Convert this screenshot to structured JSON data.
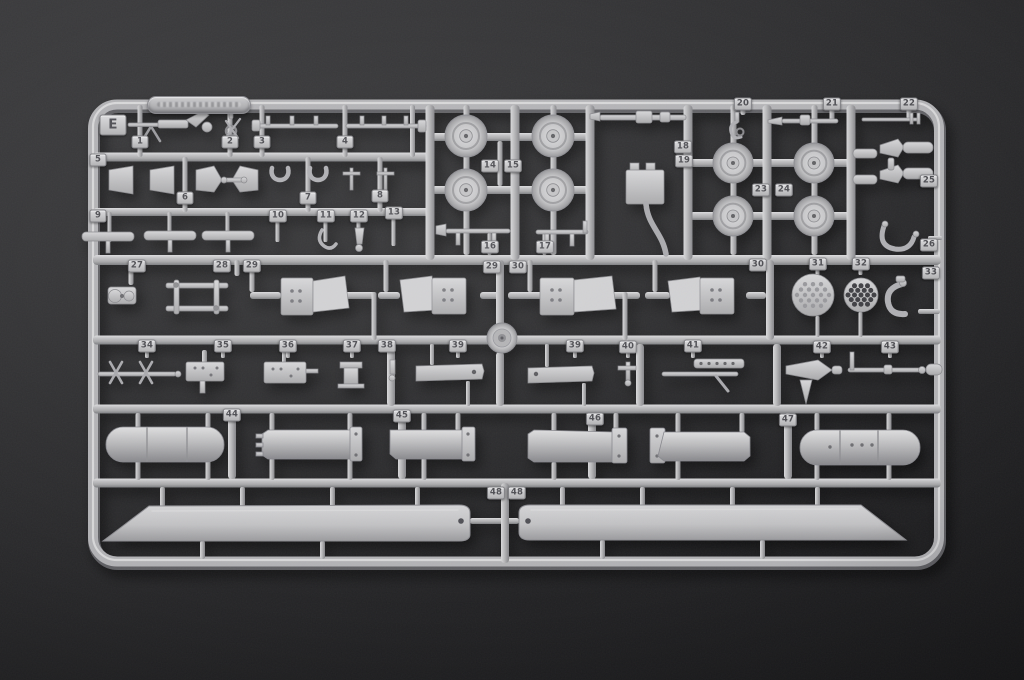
{
  "scene": {
    "description": "Photograph of a light-grey injection-moulded plastic model-kit sprue (parts runner) lying on a dark charcoal background",
    "background_color": "#2a2a2c",
    "sprue_color": "#b4b4b6",
    "part_color": "#c6c6c8",
    "tab_text_color": "#4d4d52"
  },
  "sprue": {
    "letter": "E",
    "part_number_range": "1 - 48",
    "embossed_tag_text": "",
    "notable_parts": [
      "eight road wheels",
      "four crew seats",
      "two perforated discs",
      "two cylindrical fuel tanks",
      "four rotor-blade grips",
      "two long main rotor blades (part 48)"
    ],
    "tabs": [
      {
        "label": "1",
        "x": 140,
        "y": 142
      },
      {
        "label": "2",
        "x": 230,
        "y": 142
      },
      {
        "label": "3",
        "x": 262,
        "y": 142
      },
      {
        "label": "4",
        "x": 345,
        "y": 142
      },
      {
        "label": "5",
        "x": 98,
        "y": 160
      },
      {
        "label": "6",
        "x": 185,
        "y": 198
      },
      {
        "label": "7",
        "x": 308,
        "y": 198
      },
      {
        "label": "8",
        "x": 380,
        "y": 196
      },
      {
        "label": "9",
        "x": 98,
        "y": 216
      },
      {
        "label": "10",
        "x": 278,
        "y": 216
      },
      {
        "label": "11",
        "x": 326,
        "y": 216
      },
      {
        "label": "12",
        "x": 359,
        "y": 216
      },
      {
        "label": "13",
        "x": 394,
        "y": 213
      },
      {
        "label": "14",
        "x": 490,
        "y": 166
      },
      {
        "label": "15",
        "x": 513,
        "y": 166
      },
      {
        "label": "16",
        "x": 490,
        "y": 247
      },
      {
        "label": "17",
        "x": 545,
        "y": 247
      },
      {
        "label": "18",
        "x": 683,
        "y": 147
      },
      {
        "label": "19",
        "x": 684,
        "y": 161
      },
      {
        "label": "20",
        "x": 743,
        "y": 104
      },
      {
        "label": "21",
        "x": 832,
        "y": 104
      },
      {
        "label": "22",
        "x": 909,
        "y": 104
      },
      {
        "label": "23",
        "x": 761,
        "y": 190
      },
      {
        "label": "24",
        "x": 784,
        "y": 190
      },
      {
        "label": "25",
        "x": 929,
        "y": 181
      },
      {
        "label": "26",
        "x": 929,
        "y": 245
      },
      {
        "label": "27",
        "x": 137,
        "y": 266
      },
      {
        "label": "28",
        "x": 222,
        "y": 266
      },
      {
        "label": "29",
        "x": 252,
        "y": 266
      },
      {
        "label": "29",
        "x": 492,
        "y": 267
      },
      {
        "label": "30",
        "x": 518,
        "y": 267
      },
      {
        "label": "30",
        "x": 758,
        "y": 265
      },
      {
        "label": "31",
        "x": 818,
        "y": 264
      },
      {
        "label": "32",
        "x": 861,
        "y": 264
      },
      {
        "label": "33",
        "x": 931,
        "y": 273
      },
      {
        "label": "34",
        "x": 147,
        "y": 346
      },
      {
        "label": "35",
        "x": 223,
        "y": 346
      },
      {
        "label": "36",
        "x": 288,
        "y": 346
      },
      {
        "label": "37",
        "x": 352,
        "y": 346
      },
      {
        "label": "38",
        "x": 387,
        "y": 346
      },
      {
        "label": "39",
        "x": 458,
        "y": 346
      },
      {
        "label": "39",
        "x": 575,
        "y": 346
      },
      {
        "label": "40",
        "x": 628,
        "y": 347
      },
      {
        "label": "41",
        "x": 693,
        "y": 346
      },
      {
        "label": "42",
        "x": 822,
        "y": 347
      },
      {
        "label": "43",
        "x": 890,
        "y": 347
      },
      {
        "label": "44",
        "x": 232,
        "y": 415
      },
      {
        "label": "45",
        "x": 402,
        "y": 416
      },
      {
        "label": "46",
        "x": 595,
        "y": 419
      },
      {
        "label": "47",
        "x": 788,
        "y": 420
      },
      {
        "label": "48",
        "x": 496,
        "y": 493
      },
      {
        "label": "48",
        "x": 517,
        "y": 493
      }
    ]
  }
}
